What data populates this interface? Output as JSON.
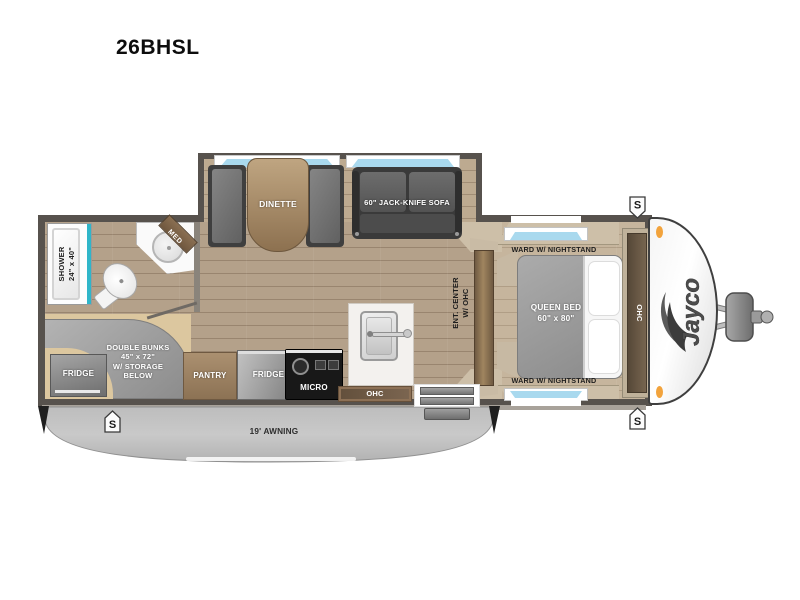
{
  "title": "26BHSL",
  "slideout": {
    "dinette_label": "DINETTE",
    "sofa_label": "60\" JACK-KNIFE SOFA"
  },
  "bathroom": {
    "shower_label": "SHOWER\n24\" x 40\"",
    "med_label": "MED"
  },
  "bunk_room": {
    "bunks_label": "DOUBLE BUNKS\n45\" x 72\"\nW/ STORAGE\nBELOW",
    "fridge_label": "FRIDGE"
  },
  "kitchen": {
    "pantry_label": "PANTRY",
    "fridge_label": "FRIDGE",
    "micro_label": "MICRO",
    "ohc_label": "OHC"
  },
  "living": {
    "ent_center_label": "ENT. CENTER\nW/ OHC"
  },
  "bedroom": {
    "ward_front_label": "WARD W/ NIGHTSTAND",
    "ward_rear_label": "WARD W/ NIGHTSTAND",
    "bed_label": "QUEEN BED\n60\" x 80\"",
    "ohc_label": "OHC"
  },
  "exterior": {
    "awning_label": "19' AWNING",
    "brand_label": "Jayco",
    "speaker_label": "S"
  },
  "colors": {
    "wall_gray": "#57524d",
    "wood_floor": "#b4a18a",
    "accent_teal": "#2fb6c9",
    "window_blue": "#a9d9ee",
    "awning_gray": "#c2c2c2",
    "marker_light_amber": "#f2a33c",
    "cabinet_brown": "#8d7156"
  }
}
